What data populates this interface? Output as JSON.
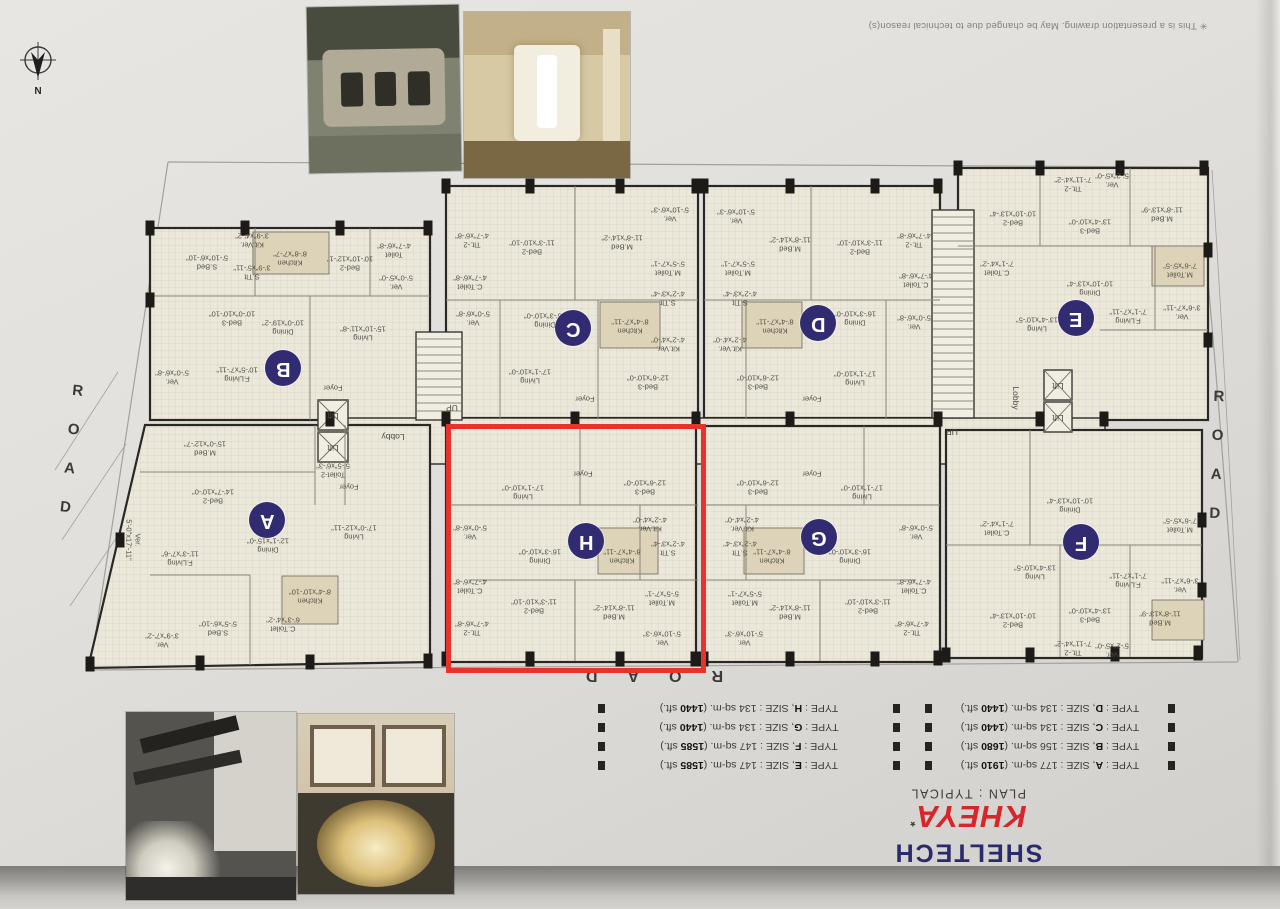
{
  "disclaimer": "✳ This is a presentation drawing. May be changed due to technical reason(s)",
  "compass_label": "N",
  "roads": {
    "left": "ROAD",
    "right": "ROAD",
    "bottom": "ROAD"
  },
  "highlight_unit": "H",
  "colors": {
    "highlight": "#e8332c",
    "brand_blue": "#2b2a6e",
    "brand_red": "#d6262b",
    "unit_circle": "#312c72"
  },
  "title_block": {
    "brand": "SHELTECH",
    "project": "KHEYA",
    "mark": "*",
    "plan_line": "PLAN : TYPICAL"
  },
  "legend": {
    "fmt": {
      "type": "TYPE",
      "size": "SIZE",
      "sqm_unit": "sq-m.",
      "sft_unit": "sft."
    },
    "left": [
      {
        "letter": "E",
        "sqm": "147",
        "sft": "1585"
      },
      {
        "letter": "F",
        "sqm": "147",
        "sft": "1585"
      },
      {
        "letter": "G",
        "sqm": "134",
        "sft": "1440"
      },
      {
        "letter": "H",
        "sqm": "134",
        "sft": "1440"
      }
    ],
    "right": [
      {
        "letter": "A",
        "sqm": "177",
        "sft": "1910"
      },
      {
        "letter": "B",
        "sqm": "156",
        "sft": "1680"
      },
      {
        "letter": "C",
        "sqm": "134",
        "sft": "1440"
      },
      {
        "letter": "D",
        "sqm": "134",
        "sft": "1440"
      }
    ]
  },
  "corridor_labels": [
    {
      "t": "Lobby",
      "x": 393,
      "y": 437
    },
    {
      "t": "Lobby",
      "x": 1016,
      "y": 398,
      "v": true
    },
    {
      "t": "UP",
      "x": 452,
      "y": 408
    },
    {
      "t": "UP",
      "x": 952,
      "y": 432
    },
    {
      "t": "Lift",
      "x": 333,
      "y": 416
    },
    {
      "t": "Lift",
      "x": 333,
      "y": 448
    },
    {
      "t": "Lift",
      "x": 1058,
      "y": 386
    },
    {
      "t": "Lift",
      "x": 1058,
      "y": 418
    }
  ],
  "units": [
    {
      "letter": "B",
      "cx": 283,
      "cy": 368,
      "rooms": [
        {
          "t": "S.Bed\n5'-10\"x6'-10\"",
          "x": 207,
          "y": 262
        },
        {
          "t": "Kit.Ver.\n3'-9\"x4'-2\"",
          "x": 252,
          "y": 240
        },
        {
          "t": "S.Tlt\n3'-9\"x5'-11\"",
          "x": 252,
          "y": 272
        },
        {
          "t": "Kitchen\n8'-8\"x7'-7\"",
          "x": 290,
          "y": 258
        },
        {
          "t": "Bed-2\n10'-10\"x12'-1\"",
          "x": 350,
          "y": 263
        },
        {
          "t": "Toilet\n4'-7\"x6'-8\"",
          "x": 394,
          "y": 250
        },
        {
          "t": "Ver.\n5'-0\"x5'-0\"",
          "x": 396,
          "y": 282
        },
        {
          "t": "Bed-3\n10'-0\"x10'-10\"",
          "x": 232,
          "y": 318
        },
        {
          "t": "Dining\n10'-0\"x19'-2\"",
          "x": 283,
          "y": 327
        },
        {
          "t": "Living\n15'-10\"x11'-8\"",
          "x": 363,
          "y": 333
        },
        {
          "t": "F.Living\n10'-5\"x7'-11\"",
          "x": 237,
          "y": 374
        },
        {
          "t": "Ver.\n5'-0\"x6'-8\"",
          "x": 172,
          "y": 377
        },
        {
          "t": "Foyer",
          "x": 333,
          "y": 387
        }
      ]
    },
    {
      "letter": "C",
      "cx": 573,
      "cy": 328,
      "rooms": [
        {
          "t": "Tlt.-2\n4'-7\"x6'-8\"",
          "x": 472,
          "y": 240
        },
        {
          "t": "Bed-2\n11'-3\"x10'-10\"",
          "x": 532,
          "y": 247
        },
        {
          "t": "M.Bed\n11'-8\"x14'-2\"",
          "x": 622,
          "y": 242
        },
        {
          "t": "Ver.\n5'-10\"x6'-3\"",
          "x": 670,
          "y": 214
        },
        {
          "t": "C.Toilet\n4'-7\"x6'-8\"",
          "x": 470,
          "y": 282
        },
        {
          "t": "M.Toilet\n5'-5\"x7'-1\"",
          "x": 668,
          "y": 268
        },
        {
          "t": "Ver.\n5'-0\"x6'-8\"",
          "x": 473,
          "y": 318
        },
        {
          "t": "Dining\n16'-3\"x10'-0\"",
          "x": 545,
          "y": 320
        },
        {
          "t": "Kitchen\n8'-4\"x7'-11\"",
          "x": 630,
          "y": 326
        },
        {
          "t": "S.Tlt\n4'-2\"x3'-4\"",
          "x": 668,
          "y": 298
        },
        {
          "t": "Kit.Ver.\n4'-2\"x4'-0\"",
          "x": 668,
          "y": 344
        },
        {
          "t": "Living\n17'-1\"x10'-0\"",
          "x": 530,
          "y": 376
        },
        {
          "t": "Bed-3\n12'-6\"x10'-0\"",
          "x": 648,
          "y": 382
        },
        {
          "t": "Foyer",
          "x": 585,
          "y": 398
        }
      ]
    },
    {
      "letter": "D",
      "cx": 818,
      "cy": 323,
      "rooms": [
        {
          "t": "Ver.\n5'-10\"x6'-3\"",
          "x": 736,
          "y": 216
        },
        {
          "t": "M.Bed\n11'-8\"x14'-2\"",
          "x": 790,
          "y": 244
        },
        {
          "t": "Bed-2\n11'-3\"x10'-10\"",
          "x": 860,
          "y": 247
        },
        {
          "t": "Tlt.-2\n4'-7\"x6'-8\"",
          "x": 914,
          "y": 240
        },
        {
          "t": "M.Toilet\n5'-5\"x7'-1\"",
          "x": 738,
          "y": 268
        },
        {
          "t": "C.Toilet\n4'-7\"x6'-8\"",
          "x": 916,
          "y": 280
        },
        {
          "t": "S.Tlt\n4'-2\"x3'-4\"",
          "x": 740,
          "y": 298
        },
        {
          "t": "Kit.Ver.\n4'-2\"x4'-0\"",
          "x": 730,
          "y": 344
        },
        {
          "t": "Kitchen\n8'-4\"x7'-11\"",
          "x": 775,
          "y": 326
        },
        {
          "t": "Dining\n16'-3\"x10'-0\"",
          "x": 855,
          "y": 318
        },
        {
          "t": "Ver.\n5'-0\"x6'-8\"",
          "x": 914,
          "y": 322
        },
        {
          "t": "Bed-3\n12'-6\"x10'-0\"",
          "x": 758,
          "y": 382
        },
        {
          "t": "Living\n17'-1\"x10'-0\"",
          "x": 855,
          "y": 378
        },
        {
          "t": "Foyer",
          "x": 812,
          "y": 398
        }
      ]
    },
    {
      "letter": "E",
      "cx": 1076,
      "cy": 318,
      "rooms": [
        {
          "t": "Tlt.-2\n7'-11\"x4'-2\"",
          "x": 1073,
          "y": 184
        },
        {
          "t": "Ver.\n5'-2\"x5'-0\"",
          "x": 1112,
          "y": 180
        },
        {
          "t": "Bed-2\n10'-10\"x13'-4\"",
          "x": 1013,
          "y": 218
        },
        {
          "t": "Bed-3\n13'-4\"x10'-0\"",
          "x": 1090,
          "y": 226
        },
        {
          "t": "M.Bed\n11'-8\"x13'-9\"",
          "x": 1162,
          "y": 214
        },
        {
          "t": "C.Toilet\n7'-1\"x4'-2\"",
          "x": 997,
          "y": 268
        },
        {
          "t": "M.Toilet\n7'-6\"x5'-5\"",
          "x": 1180,
          "y": 270
        },
        {
          "t": "Dining\n10'-10\"x13'-4\"",
          "x": 1090,
          "y": 288
        },
        {
          "t": "Living\n13'-4\"x10'-5\"",
          "x": 1037,
          "y": 324
        },
        {
          "t": "F.Living\n7'-1\"x7'-11\"",
          "x": 1128,
          "y": 316
        },
        {
          "t": "Ver.\n3'-6\"x7'-11\"",
          "x": 1182,
          "y": 312
        }
      ]
    },
    {
      "letter": "A",
      "cx": 267,
      "cy": 520,
      "rooms": [
        {
          "t": "M.Bed\n15'-0\"x12'-7\"",
          "x": 205,
          "y": 448
        },
        {
          "t": "Bed-2\n14'-7\"x10'-0\"",
          "x": 213,
          "y": 496
        },
        {
          "t": "Toilet-2\n5'-5\"x6'-3\"",
          "x": 333,
          "y": 470
        },
        {
          "t": "Foyer",
          "x": 349,
          "y": 486
        },
        {
          "t": "Living\n17'-0\"x12'-11\"",
          "x": 354,
          "y": 532
        },
        {
          "t": "Dining\n12'-1\"x15'-0\"",
          "x": 268,
          "y": 545
        },
        {
          "t": "F.Living\n11'-3\"x7'-6\"",
          "x": 180,
          "y": 558
        },
        {
          "t": "Ver.\n5'-0\"x17'-11\"",
          "x": 133,
          "y": 540,
          "v": true
        },
        {
          "t": "Kitchen\n8'-4\"x10'-10\"",
          "x": 310,
          "y": 596
        },
        {
          "t": "C.Toilet\n6'-3\"x4'-2\"",
          "x": 283,
          "y": 624
        },
        {
          "t": "S.Bed\n5'-5\"x6'-10\"",
          "x": 218,
          "y": 628
        },
        {
          "t": "Ver.\n3'-9\"x7'-2\"",
          "x": 162,
          "y": 640
        }
      ]
    },
    {
      "letter": "H",
      "cx": 586,
      "cy": 541,
      "rooms": [
        {
          "t": "Foyer",
          "x": 583,
          "y": 473
        },
        {
          "t": "Living\n17'-1\"x10'-0\"",
          "x": 523,
          "y": 492
        },
        {
          "t": "Bed-3\n12'-6\"x10'-0\"",
          "x": 645,
          "y": 487
        },
        {
          "t": "Ver.\n5'-0\"x6'-8\"",
          "x": 470,
          "y": 532
        },
        {
          "t": "Dining\n16'-3\"x10'-0\"",
          "x": 540,
          "y": 556
        },
        {
          "t": "Kit.Ver.\n4'-2\"x4'-0\"",
          "x": 650,
          "y": 524
        },
        {
          "t": "Kitchen\n8'-4\"x7'-11\"",
          "x": 622,
          "y": 556
        },
        {
          "t": "S.Tlt\n4'-2\"x3'-4\"",
          "x": 668,
          "y": 548
        },
        {
          "t": "C.Toilet\n4'-7\"x6'-8\"",
          "x": 470,
          "y": 586
        },
        {
          "t": "Tlt.-2\n4'-7\"x6'-8\"",
          "x": 472,
          "y": 628
        },
        {
          "t": "Bed-2\n11'-3\"x10'-10\"",
          "x": 534,
          "y": 606
        },
        {
          "t": "M.Bed\n11'-8\"x14'-2\"",
          "x": 614,
          "y": 612
        },
        {
          "t": "M.Toilet\n5'-5\"x7'-1\"",
          "x": 662,
          "y": 598
        },
        {
          "t": "Ver.\n5'-10\"x6'-3\"",
          "x": 662,
          "y": 638
        }
      ]
    },
    {
      "letter": "G",
      "cx": 819,
      "cy": 537,
      "rooms": [
        {
          "t": "Foyer",
          "x": 812,
          "y": 473
        },
        {
          "t": "Bed-3\n12'-6\"x10'-0\"",
          "x": 758,
          "y": 487
        },
        {
          "t": "Living\n17'-1\"x10'-0\"",
          "x": 862,
          "y": 492
        },
        {
          "t": "Kit.Ver.\n4'-2\"x4'-0\"",
          "x": 742,
          "y": 524
        },
        {
          "t": "S.Tlt\n4'-2\"x3'-4\"",
          "x": 740,
          "y": 548
        },
        {
          "t": "Kitchen\n8'-4\"x7'-11\"",
          "x": 772,
          "y": 556
        },
        {
          "t": "Dining\n16'-3\"x10'-0\"",
          "x": 850,
          "y": 556
        },
        {
          "t": "Ver.\n5'-0\"x6'-8\"",
          "x": 916,
          "y": 532
        },
        {
          "t": "M.Toilet\n5'-5\"x7'-1\"",
          "x": 745,
          "y": 598
        },
        {
          "t": "C.Toilet\n4'-7\"x6'-8\"",
          "x": 914,
          "y": 586
        },
        {
          "t": "M.Bed\n11'-8\"x14'-2\"",
          "x": 790,
          "y": 612
        },
        {
          "t": "Bed-2\n11'-3\"x10'-10\"",
          "x": 868,
          "y": 606
        },
        {
          "t": "Ver.\n5'-10\"x6'-3\"",
          "x": 744,
          "y": 638
        },
        {
          "t": "Tlt.-2\n4'-7\"x6'-8\"",
          "x": 912,
          "y": 628
        }
      ]
    },
    {
      "letter": "F",
      "cx": 1081,
      "cy": 542,
      "rooms": [
        {
          "t": "Dining\n10'-10\"x13'-4\"",
          "x": 1070,
          "y": 505
        },
        {
          "t": "Living\n13'-4\"x10'-5\"",
          "x": 1035,
          "y": 572
        },
        {
          "t": "F.Living\n7'-1\"x7'-11\"",
          "x": 1128,
          "y": 580
        },
        {
          "t": "Ver.\n3'-6\"x7'-11\"",
          "x": 1180,
          "y": 585
        },
        {
          "t": "C.Toilet\n7'-1\"x4'-2\"",
          "x": 997,
          "y": 528
        },
        {
          "t": "M.Toilet\n7'-6\"x5'-5\"",
          "x": 1180,
          "y": 525
        },
        {
          "t": "Bed-2\n10'-10\"x13'-4\"",
          "x": 1013,
          "y": 620
        },
        {
          "t": "Bed-3\n13'-4\"x10'-0\"",
          "x": 1090,
          "y": 615
        },
        {
          "t": "M.Bed\n11'-8\"x13'-9\"",
          "x": 1160,
          "y": 618
        },
        {
          "t": "Tlt.-2\n7'-11\"x4'-2\"",
          "x": 1073,
          "y": 648
        },
        {
          "t": "Ver.\n5'-2\"x5'-0\"",
          "x": 1112,
          "y": 650
        }
      ]
    }
  ],
  "photos": [
    {
      "name": "landscaping-rock-feature"
    },
    {
      "name": "bathroom-interior"
    },
    {
      "name": "lobby-staircase-chandelier"
    },
    {
      "name": "wall-decor-chandelier"
    }
  ]
}
